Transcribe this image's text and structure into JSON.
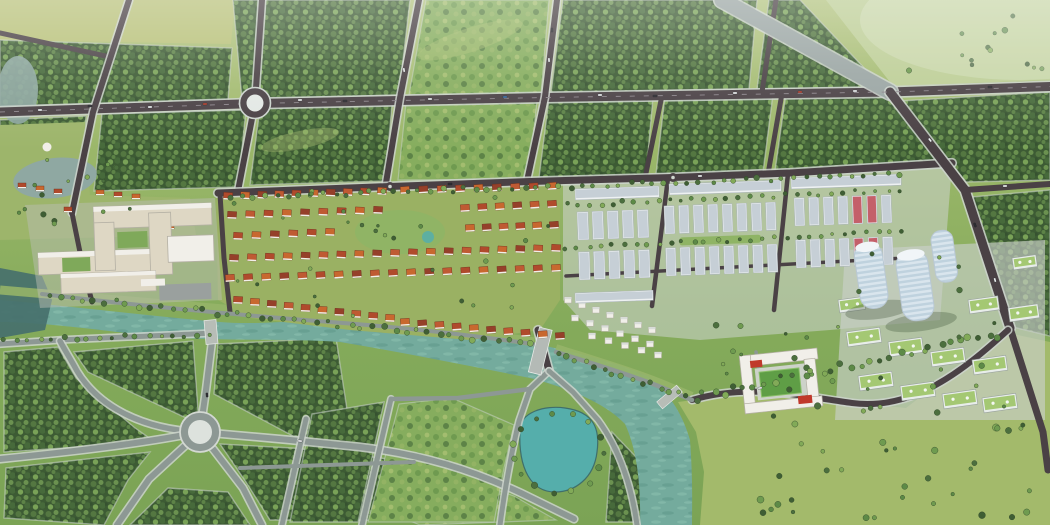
{
  "meta": {
    "width": 1050,
    "height": 525,
    "description": "Aerial 3D masterplan rendering of a new township: forest blocks with a road grid and roundabout at top, a hospital campus and red-roof villa district in the middle, white shophouse rows and curved high-rise towers at right, a teal river with bridges, a landscaped park with a large roundabout at bottom-left, a pond and open meadows at bottom-right."
  },
  "palette": {
    "landTop": "#b2c37f",
    "landMid": "#93b264",
    "landLow": "#7ba355",
    "fieldYellow": "#b8c179",
    "meadowPale": "#bdCE96",
    "meadowSE": "#a3ba6b",
    "forestDark": "#3d5b34",
    "forestMid": "#547741",
    "treeLight": "#79a257",
    "roadDark": "#4a4145",
    "roadPark": "#8d9894",
    "roadLight": "#9aa5a3",
    "curb": "#ccd3cd",
    "laneMark": "#8d868c",
    "white": "#f1efe9",
    "cream": "#ded7c4",
    "shadowSide": "#b4b0a4",
    "redRoof": "#b04a2c",
    "orangeRoof": "#c8682f",
    "darkRed": "#95402a",
    "red2": "#bf5a33",
    "pinkRoof": "#c4606a",
    "shopRoof": "#c6cfd6",
    "shopWall": "#eef1f2",
    "towerGlass": "#d9e5ed",
    "towerLine": "#bfd2de",
    "greenRoof": "#a4c873",
    "riverTeal": "#74ab9d",
    "riverLight": "#86bcac",
    "pondTeal": "#55aeab",
    "waterDark": "#47706d",
    "paleWater": "#8fa8a2",
    "lawn": "#9db56b",
    "sportsField": "#5f9e46",
    "carWhite": "#eef1f2",
    "carDark": "#2e2d33",
    "carRed": "#b3402e",
    "carBlue": "#3c6ea5"
  },
  "scene": {
    "villa_rows": [
      {
        "x0": 228,
        "y0": 196,
        "x1": 382,
        "y1": 191,
        "n": 10
      },
      {
        "x0": 405,
        "y0": 190,
        "x1": 552,
        "y1": 186,
        "n": 9
      },
      {
        "x0": 232,
        "y0": 215,
        "x1": 378,
        "y1": 210,
        "n": 9
      },
      {
        "x0": 465,
        "y0": 208,
        "x1": 552,
        "y1": 204,
        "n": 6
      },
      {
        "x0": 238,
        "y0": 236,
        "x1": 330,
        "y1": 232,
        "n": 6
      },
      {
        "x0": 470,
        "y0": 228,
        "x1": 554,
        "y1": 225,
        "n": 6
      },
      {
        "x0": 234,
        "y0": 258,
        "x1": 556,
        "y1": 248,
        "n": 19
      },
      {
        "x0": 230,
        "y0": 278,
        "x1": 556,
        "y1": 268,
        "n": 19
      },
      {
        "x0": 238,
        "y0": 300,
        "x1": 390,
        "y1": 318,
        "n": 10
      },
      {
        "x0": 405,
        "y0": 322,
        "x1": 560,
        "y1": 336,
        "n": 10
      }
    ],
    "white_villa_rows": [
      {
        "x0": 568,
        "y0": 300,
        "x1": 652,
        "y1": 330,
        "n": 7
      },
      {
        "x0": 575,
        "y0": 318,
        "x1": 650,
        "y1": 344,
        "n": 6
      },
      {
        "x0": 592,
        "y0": 336,
        "x1": 658,
        "y1": 355,
        "n": 5
      }
    ],
    "shophouse_strips": [
      {
        "x": 575,
        "y": 189,
        "w": 84,
        "h": 11
      },
      {
        "x": 669,
        "y": 184,
        "w": 112,
        "h": 11
      },
      {
        "x": 791,
        "y": 178,
        "w": 110,
        "h": 11
      },
      {
        "x": 575,
        "y": 293,
        "w": 78,
        "h": 10
      }
    ],
    "shophouse_blocks": [
      {
        "x": 577,
        "y": 212,
        "cols": 5,
        "gx": 15,
        "rows": 2,
        "gy": 40,
        "cw": 11,
        "ch": 28,
        "pink": []
      },
      {
        "x": 664,
        "y": 206,
        "cols": 8,
        "gx": 14.5,
        "rows": 2,
        "gy": 42,
        "cw": 10,
        "ch": 28,
        "court": true,
        "pink": []
      },
      {
        "x": 794,
        "y": 198,
        "cols": 7,
        "gx": 14.5,
        "rows": 2,
        "gy": 42,
        "cw": 10,
        "ch": 28,
        "pink": [
          4,
          5
        ]
      }
    ],
    "apartments": [
      {
        "x": 846,
        "y": 332,
        "w": 34,
        "h": 15
      },
      {
        "x": 888,
        "y": 342,
        "w": 34,
        "h": 15
      },
      {
        "x": 930,
        "y": 352,
        "w": 34,
        "h": 15
      },
      {
        "x": 972,
        "y": 360,
        "w": 34,
        "h": 15
      },
      {
        "x": 858,
        "y": 376,
        "w": 34,
        "h": 15
      },
      {
        "x": 900,
        "y": 386,
        "w": 34,
        "h": 15
      },
      {
        "x": 942,
        "y": 394,
        "w": 34,
        "h": 15
      },
      {
        "x": 982,
        "y": 398,
        "w": 34,
        "h": 15
      },
      {
        "x": 968,
        "y": 300,
        "w": 30,
        "h": 14
      },
      {
        "x": 1008,
        "y": 308,
        "w": 30,
        "h": 14
      },
      {
        "x": 838,
        "y": 300,
        "w": 26,
        "h": 13
      },
      {
        "x": 1012,
        "y": 258,
        "w": 24,
        "h": 12
      }
    ],
    "pavilions": [
      {
        "x": 18,
        "y": 183
      },
      {
        "x": 36,
        "y": 186
      },
      {
        "x": 54,
        "y": 189
      },
      {
        "x": 96,
        "y": 190
      },
      {
        "x": 114,
        "y": 192
      },
      {
        "x": 132,
        "y": 194
      },
      {
        "x": 152,
        "y": 216
      },
      {
        "x": 166,
        "y": 224
      },
      {
        "x": 158,
        "y": 234
      },
      {
        "x": 174,
        "y": 242
      },
      {
        "x": 64,
        "y": 207
      }
    ],
    "tree_lines": [
      {
        "x0": 230,
        "y0": 198,
        "x1": 900,
        "y1": 174,
        "n": 58,
        "r": 2.2,
        "j": 2.5
      },
      {
        "x0": 48,
        "y0": 296,
        "x1": 530,
        "y1": 343,
        "n": 44,
        "r": 2.4,
        "j": 3
      },
      {
        "x0": 556,
        "y0": 352,
        "x1": 688,
        "y1": 398,
        "n": 15,
        "r": 2.4,
        "j": 3
      },
      {
        "x0": 695,
        "y0": 398,
        "x1": 1000,
        "y1": 334,
        "n": 32,
        "r": 2.6,
        "j": 4
      },
      {
        "x0": 4,
        "y0": 341,
        "x1": 208,
        "y1": 335,
        "n": 18,
        "r": 2.2,
        "j": 2.5
      },
      {
        "x0": 566,
        "y0": 205,
        "x1": 900,
        "y1": 190,
        "n": 30,
        "r": 1.9,
        "j": 2
      },
      {
        "x0": 566,
        "y0": 248,
        "x1": 902,
        "y1": 232,
        "n": 30,
        "r": 1.9,
        "j": 2
      }
    ],
    "tree_rings": [
      {
        "cx": 558,
        "cy": 452,
        "rx": 46,
        "ry": 40,
        "n": 15,
        "r": 2.6
      }
    ],
    "tree_scatter": [
      {
        "x": 760,
        "y": 402,
        "w": 280,
        "h": 116,
        "n": 40,
        "r": 2.6
      },
      {
        "x": 900,
        "y": 6,
        "w": 145,
        "h": 68,
        "n": 13,
        "r": 2.2
      },
      {
        "x": 228,
        "y": 186,
        "w": 326,
        "h": 134,
        "n": 28,
        "r": 1.7
      },
      {
        "x": 4,
        "y": 132,
        "w": 175,
        "h": 92,
        "n": 15,
        "r": 2.0
      },
      {
        "x": 832,
        "y": 244,
        "w": 205,
        "h": 166,
        "n": 16,
        "r": 2.1
      },
      {
        "x": 700,
        "y": 310,
        "w": 110,
        "h": 80,
        "n": 12,
        "r": 2.2
      }
    ],
    "cars": [
      {
        "x": 40,
        "y": 110,
        "a": -1,
        "c": "carWhite"
      },
      {
        "x": 90,
        "y": 106,
        "a": -2,
        "c": "carDark"
      },
      {
        "x": 150,
        "y": 107,
        "a": -2,
        "c": "carWhite"
      },
      {
        "x": 205,
        "y": 104,
        "a": -2,
        "c": "carRed"
      },
      {
        "x": 300,
        "y": 100,
        "a": -1,
        "c": "carWhite"
      },
      {
        "x": 345,
        "y": 101,
        "a": -1,
        "c": "carDark"
      },
      {
        "x": 430,
        "y": 99,
        "a": -1,
        "c": "carWhite"
      },
      {
        "x": 505,
        "y": 97,
        "a": -1,
        "c": "carBlue"
      },
      {
        "x": 600,
        "y": 95,
        "a": -1,
        "c": "carWhite"
      },
      {
        "x": 655,
        "y": 96,
        "a": -1,
        "c": "carDark"
      },
      {
        "x": 735,
        "y": 93,
        "a": -1,
        "c": "carWhite"
      },
      {
        "x": 800,
        "y": 92,
        "a": -1,
        "c": "carRed"
      },
      {
        "x": 855,
        "y": 91,
        "a": -1,
        "c": "carWhite"
      },
      {
        "x": 990,
        "y": 87,
        "a": -2,
        "c": "carDark"
      },
      {
        "x": 549,
        "y": 60,
        "a": 86,
        "c": "carWhite"
      },
      {
        "x": 552,
        "y": 30,
        "a": 86,
        "c": "carDark"
      },
      {
        "x": 404,
        "y": 70,
        "a": 80,
        "c": "carWhite"
      },
      {
        "x": 930,
        "y": 140,
        "a": 52,
        "c": "carWhite"
      },
      {
        "x": 975,
        "y": 225,
        "a": 70,
        "c": "carDark"
      },
      {
        "x": 995,
        "y": 280,
        "a": 74,
        "c": "carWhite"
      },
      {
        "x": 207,
        "y": 395,
        "a": 85,
        "c": "carDark"
      },
      {
        "x": 300,
        "y": 441,
        "a": 5,
        "c": "carWhite"
      },
      {
        "x": 450,
        "y": 184,
        "a": -2,
        "c": "carDark"
      },
      {
        "x": 700,
        "y": 176,
        "a": -2,
        "c": "carWhite"
      },
      {
        "x": 760,
        "y": 388,
        "a": -8,
        "c": "carWhite"
      },
      {
        "x": 1005,
        "y": 186,
        "a": -2,
        "c": "carWhite"
      }
    ]
  }
}
